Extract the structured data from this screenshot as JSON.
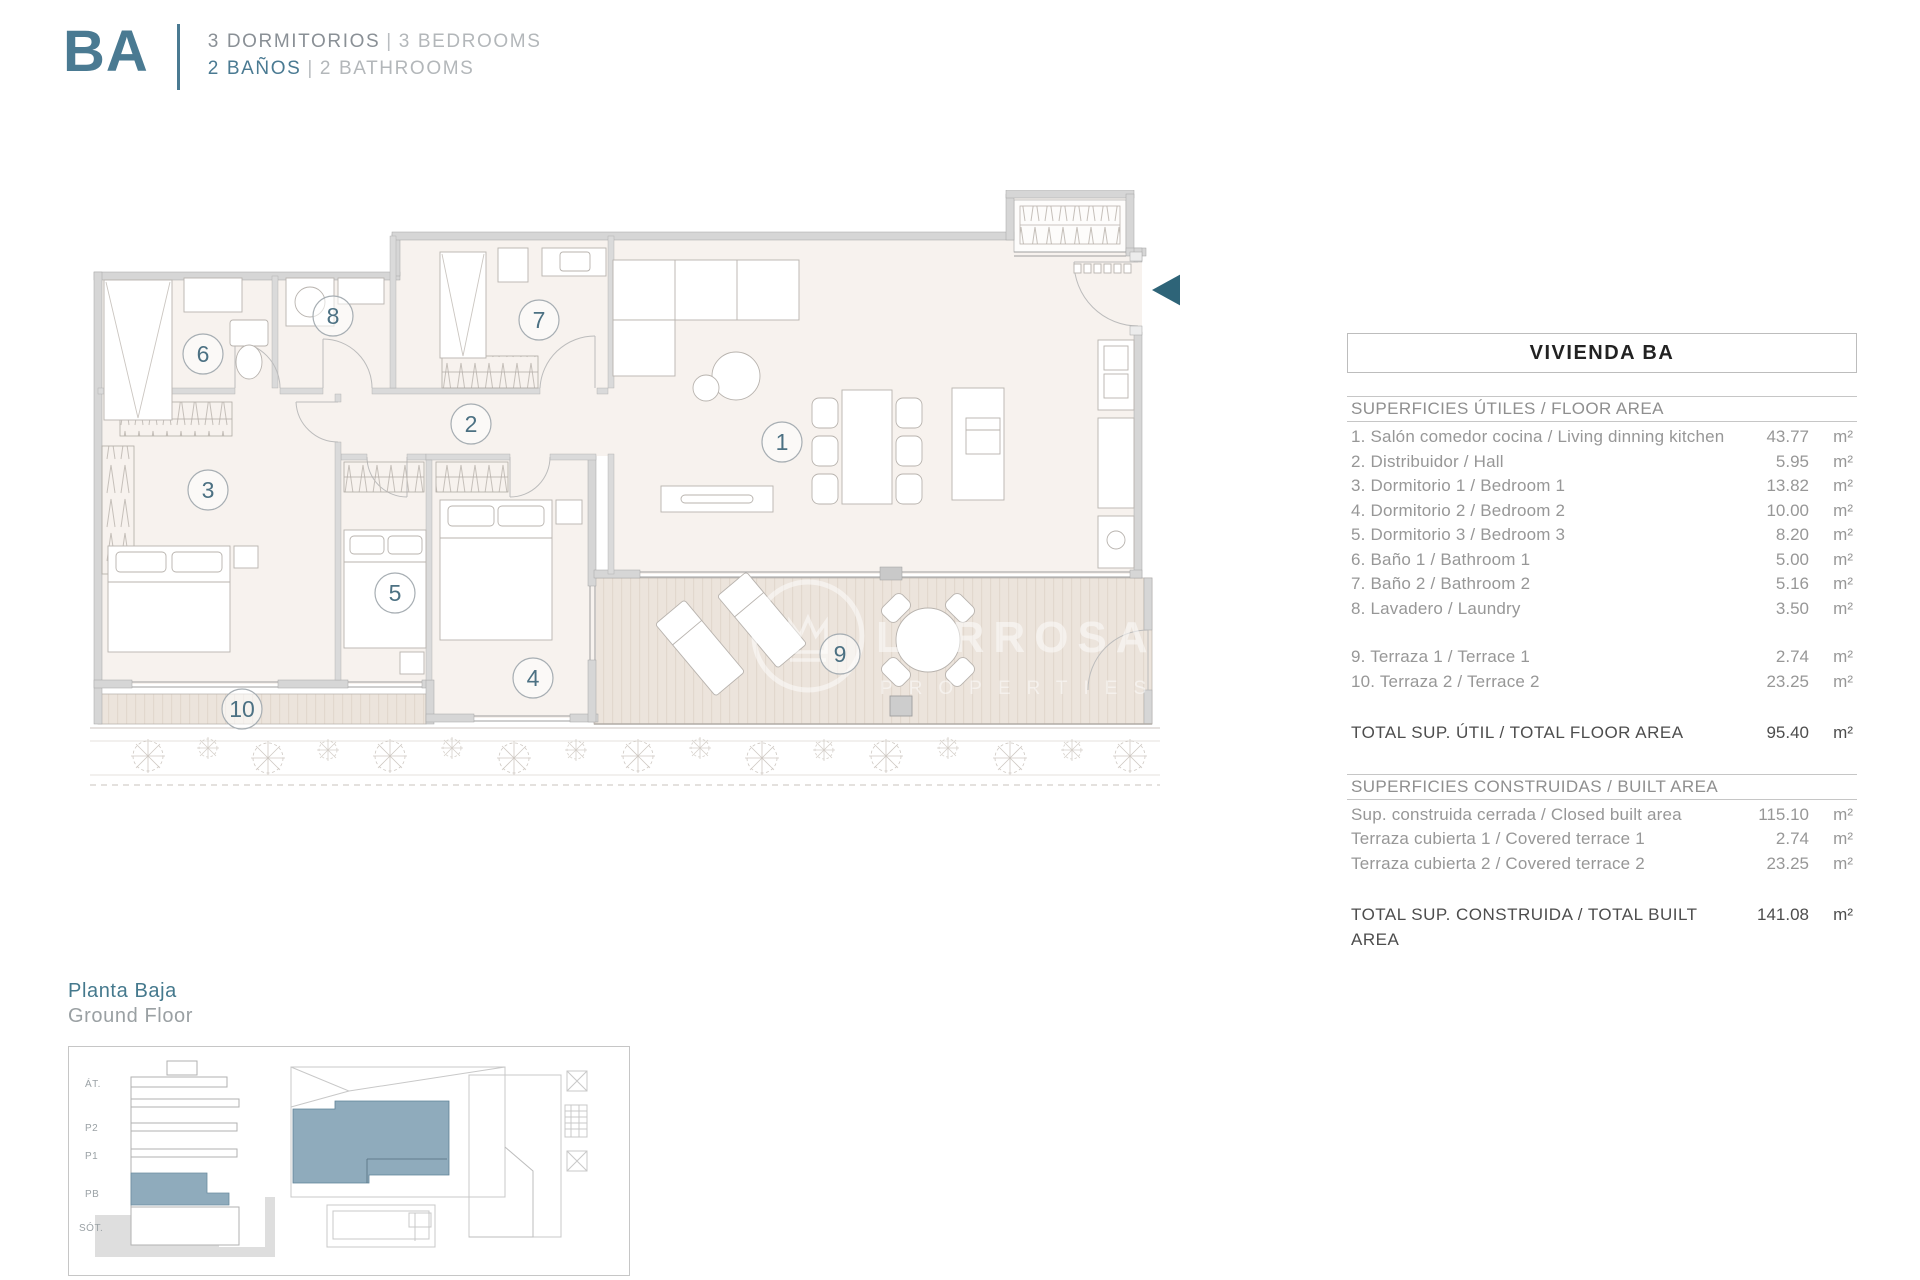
{
  "header": {
    "unit_code": "BA",
    "line1_es": "3 DORMITORIOS",
    "line1_en": "3 BEDROOMS",
    "line2_es": "2 BAÑOS",
    "line2_en": "2 BATHROOMS",
    "separator": "|"
  },
  "plan": {
    "room_numbers": [
      "1",
      "2",
      "3",
      "4",
      "5",
      "6",
      "7",
      "8",
      "9",
      "10"
    ],
    "watermark": {
      "line1": "LARROSA&CO",
      "line2": "PROPERTIES"
    }
  },
  "table": {
    "title": "VIVIENDA BA",
    "floor_area": {
      "header": "SUPERFICIES ÚTILES / FLOOR AREA",
      "rows": [
        {
          "label": "1. Salón comedor cocina / Living dinning kitchen",
          "value": "43.77",
          "unit": "m²"
        },
        {
          "label": "2. Distribuidor / Hall",
          "value": "5.95",
          "unit": "m²"
        },
        {
          "label": "3. Dormitorio 1 / Bedroom 1",
          "value": "13.82",
          "unit": "m²"
        },
        {
          "label": "4. Dormitorio 2 / Bedroom 2",
          "value": "10.00",
          "unit": "m²"
        },
        {
          "label": "5. Dormitorio 3 / Bedroom 3",
          "value": "8.20",
          "unit": "m²"
        },
        {
          "label": "6. Baño 1 / Bathroom 1",
          "value": "5.00",
          "unit": "m²"
        },
        {
          "label": "7. Baño 2 / Bathroom 2",
          "value": "5.16",
          "unit": "m²"
        },
        {
          "label": "8. Lavadero / Laundry",
          "value": "3.50",
          "unit": "m²"
        },
        {
          "label": "9. Terraza 1 / Terrace 1",
          "value": "2.74",
          "unit": "m²"
        },
        {
          "label": "10. Terraza 2 / Terrace 2",
          "value": "23.25",
          "unit": "m²"
        }
      ],
      "total": {
        "label": "TOTAL SUP. ÚTIL / TOTAL FLOOR AREA",
        "value": "95.40",
        "unit": "m²"
      }
    },
    "built_area": {
      "header": "SUPERFICIES CONSTRUIDAS / BUILT AREA",
      "rows": [
        {
          "label": "Sup. construida cerrada / Closed built area",
          "value": "115.10",
          "unit": "m²"
        },
        {
          "label": "Terraza cubierta 1 / Covered terrace 1",
          "value": "2.74",
          "unit": "m²"
        },
        {
          "label": "Terraza cubierta 2 / Covered terrace 2",
          "value": "23.25",
          "unit": "m²"
        }
      ],
      "total": {
        "label": "TOTAL SUP. CONSTRUIDA /  TOTAL BUILT AREA",
        "value": "141.08",
        "unit": "m²"
      }
    }
  },
  "ground_floor": {
    "title_es": "Planta Baja",
    "title_en": "Ground Floor",
    "levels": [
      "ÁT.",
      "P2",
      "P1",
      "PB",
      "SÓT."
    ]
  },
  "colors": {
    "brand_teal": "#4a7a92",
    "entry_arrow_teal": "#2e6478",
    "highlight_blue": "#8fabbc",
    "floor_cream": "#f7f2ee",
    "deck_beige": "#ece4dc",
    "wall_gray": "#d6d6d6",
    "table_text_gray": "#979797"
  }
}
